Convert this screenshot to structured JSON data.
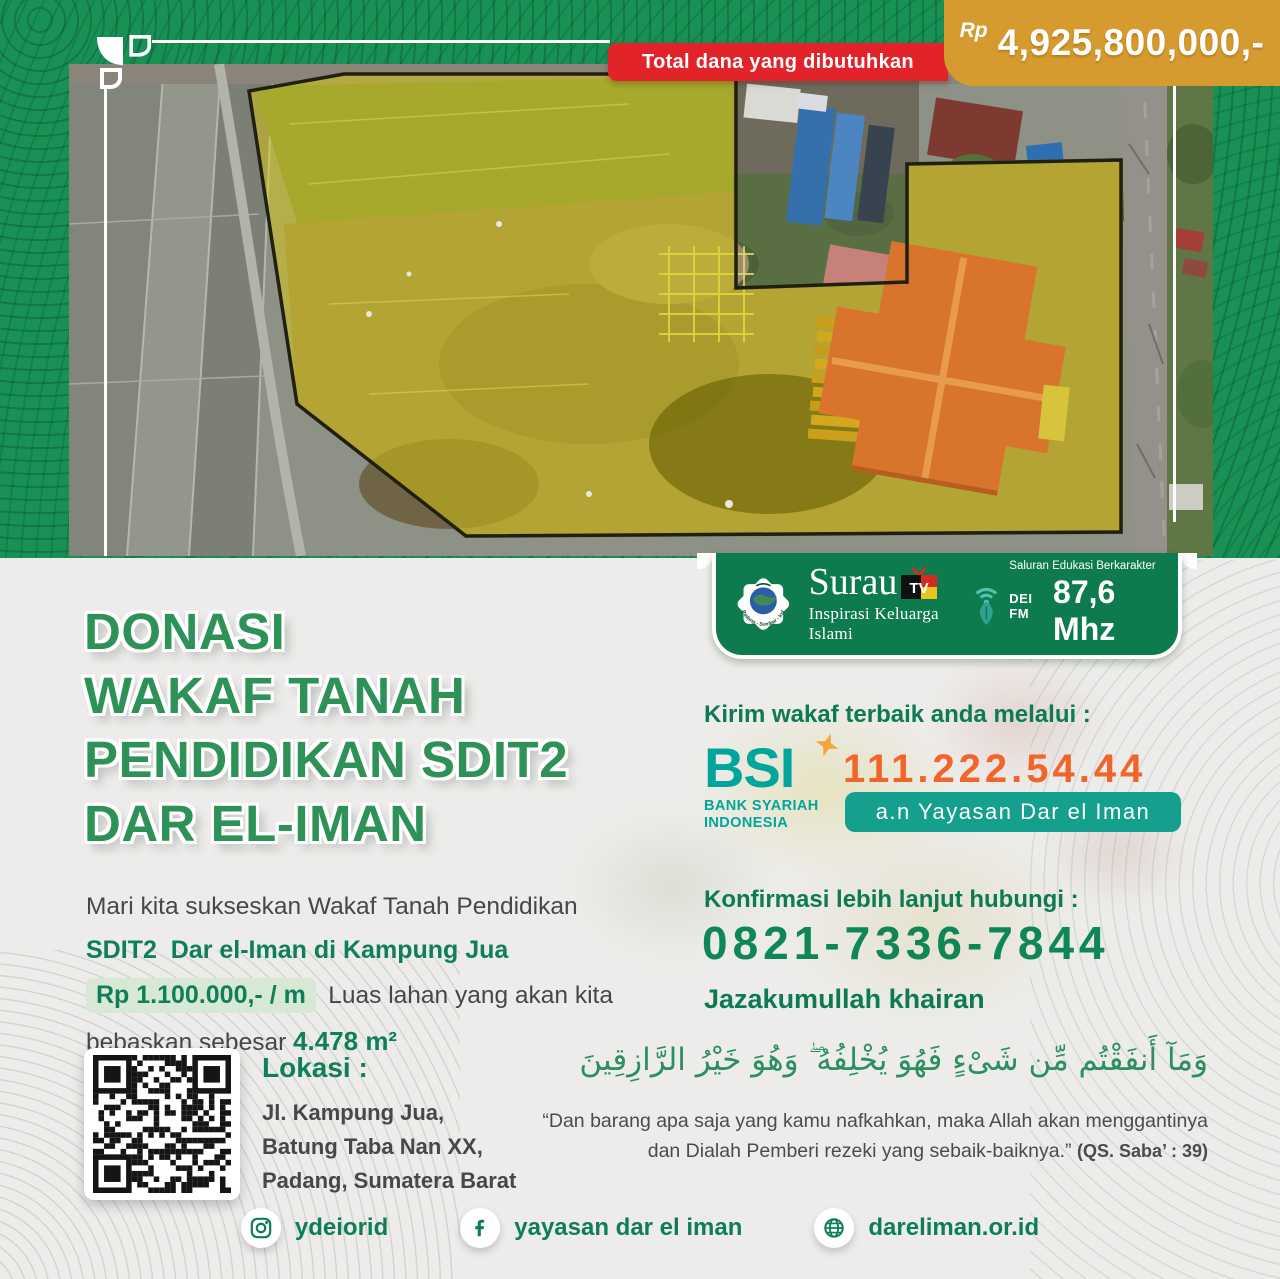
{
  "colors": {
    "band_green": "#189155",
    "panel_green": "#0e7b4e",
    "ribbon_red": "#e2232a",
    "gold": "#d59b2e",
    "title_green": "#2e9158",
    "accent_green": "#0f7f58",
    "bsi_teal": "#00a69b",
    "account_orange": "#f2652a",
    "pill_teal": "#15a08e",
    "dark_text": "#47474a"
  },
  "header": {
    "ribbon_label": "Total dana yang dibutuhkan",
    "currency_symbol": "Rp",
    "amount": "4,925,800,000,-"
  },
  "logo_bar": {
    "yayasan_caption": "Padang - Sumbar - Indonesia",
    "surau_tv": {
      "name": "Surau",
      "tv": "TV",
      "tagline": "Inspirasi Keluarga Islami"
    },
    "dei_fm": {
      "station": "DEI FM",
      "tagline": "Saluran Edukasi Berkarakter",
      "frequency": "87,6 Mhz"
    }
  },
  "title": {
    "lines": [
      "DONASI",
      "WAKAF TANAH",
      "PENDIDIKAN SDIT2",
      "DAR EL-IMAN"
    ]
  },
  "body": {
    "intro": "Mari kita sukseskan Wakaf Tanah Pendidikan",
    "highlight_line": "SDIT2  Dar el-Iman di Kampung Jua",
    "price": "Rp 1.100.000,- / m",
    "after_price": "Luas lahan yang akan kita",
    "line_last": "bebaskan sebesar ",
    "area": "4.478 m²"
  },
  "donation": {
    "heading": "Kirim wakaf terbaik anda melalui :",
    "bank_acronym": "BSI",
    "bank_name_line1": "BANK SYARIAH",
    "bank_name_line2": "INDONESIA",
    "account_number": "111.222.54.44",
    "account_holder": "a.n Yayasan Dar el Iman"
  },
  "contact": {
    "heading": "Konfirmasi lebih lanjut hubungi :",
    "phone": "0821-7336-7844",
    "closing": "Jazakumullah khairan"
  },
  "location": {
    "heading": "Lokasi :",
    "lines": [
      "Jl. Kampung Jua,",
      "Batung Taba Nan XX,",
      "Padang, Sumatera Barat"
    ]
  },
  "verse": {
    "arabic": "وَمَآ أَنفَقْتُم مِّن شَىْءٍ فَهُوَ يُخْلِفُهُ ۖ وَهُوَ خَيْرُ الرَّازِقِينَ",
    "quote_line1": "“Dan barang apa saja yang kamu nafkahkan, maka Allah akan menggantinya",
    "quote_line2": "dan Dialah Pemberi rezeki yang sebaik-baiknya.” ",
    "reference": "(QS. Saba’ : 39)"
  },
  "footer": {
    "instagram_handle": "ydeiorid",
    "facebook_name": "yayasan dar el iman",
    "website": "dareliman.or.id"
  }
}
